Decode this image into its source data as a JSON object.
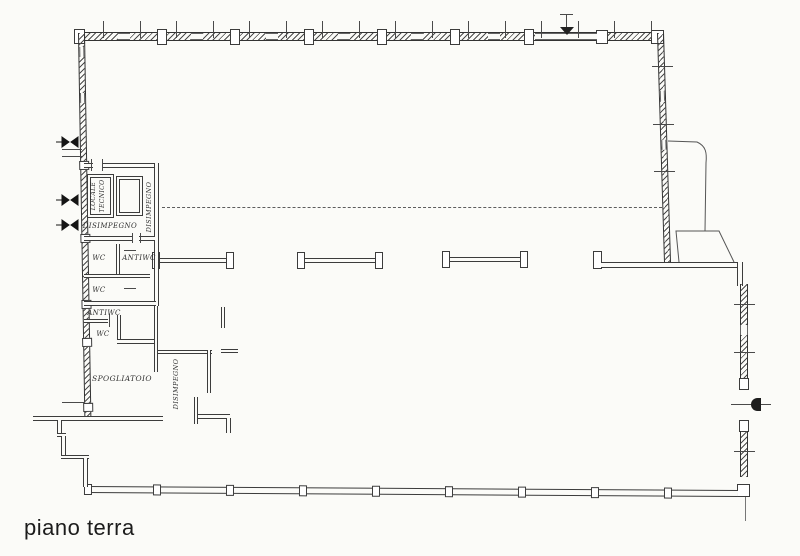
{
  "drawing": {
    "title": "piano terra",
    "type": "architectural floor plan (ground floor)",
    "rooms": [
      {
        "id": "locale-tecnico",
        "label": "LOCALE TECNICO",
        "orientation": "vertical"
      },
      {
        "id": "disimpegno-upper",
        "label": "DISIMPEGNO",
        "orientation": "vertical"
      },
      {
        "id": "disimpegno-entry",
        "label": "DISIMPEGNO",
        "orientation": "horizontal"
      },
      {
        "id": "wc-top",
        "label": "WC",
        "orientation": "horizontal"
      },
      {
        "id": "antiwc-top",
        "label": "ANTIWC",
        "orientation": "horizontal"
      },
      {
        "id": "wc-middle",
        "label": "WC",
        "orientation": "horizontal"
      },
      {
        "id": "antiwc-lower",
        "label": "ANTIWC",
        "orientation": "horizontal"
      },
      {
        "id": "wc-lower",
        "label": "WC",
        "orientation": "horizontal"
      },
      {
        "id": "spogliatoio",
        "label": "SPOGLIATOIO",
        "orientation": "horizontal"
      },
      {
        "id": "disimpegno-corridor",
        "label": "DISIMPEGNO",
        "orientation": "vertical"
      }
    ]
  },
  "colors": {
    "paper": "#fbfbf8",
    "ink": "#3c3c3c"
  }
}
